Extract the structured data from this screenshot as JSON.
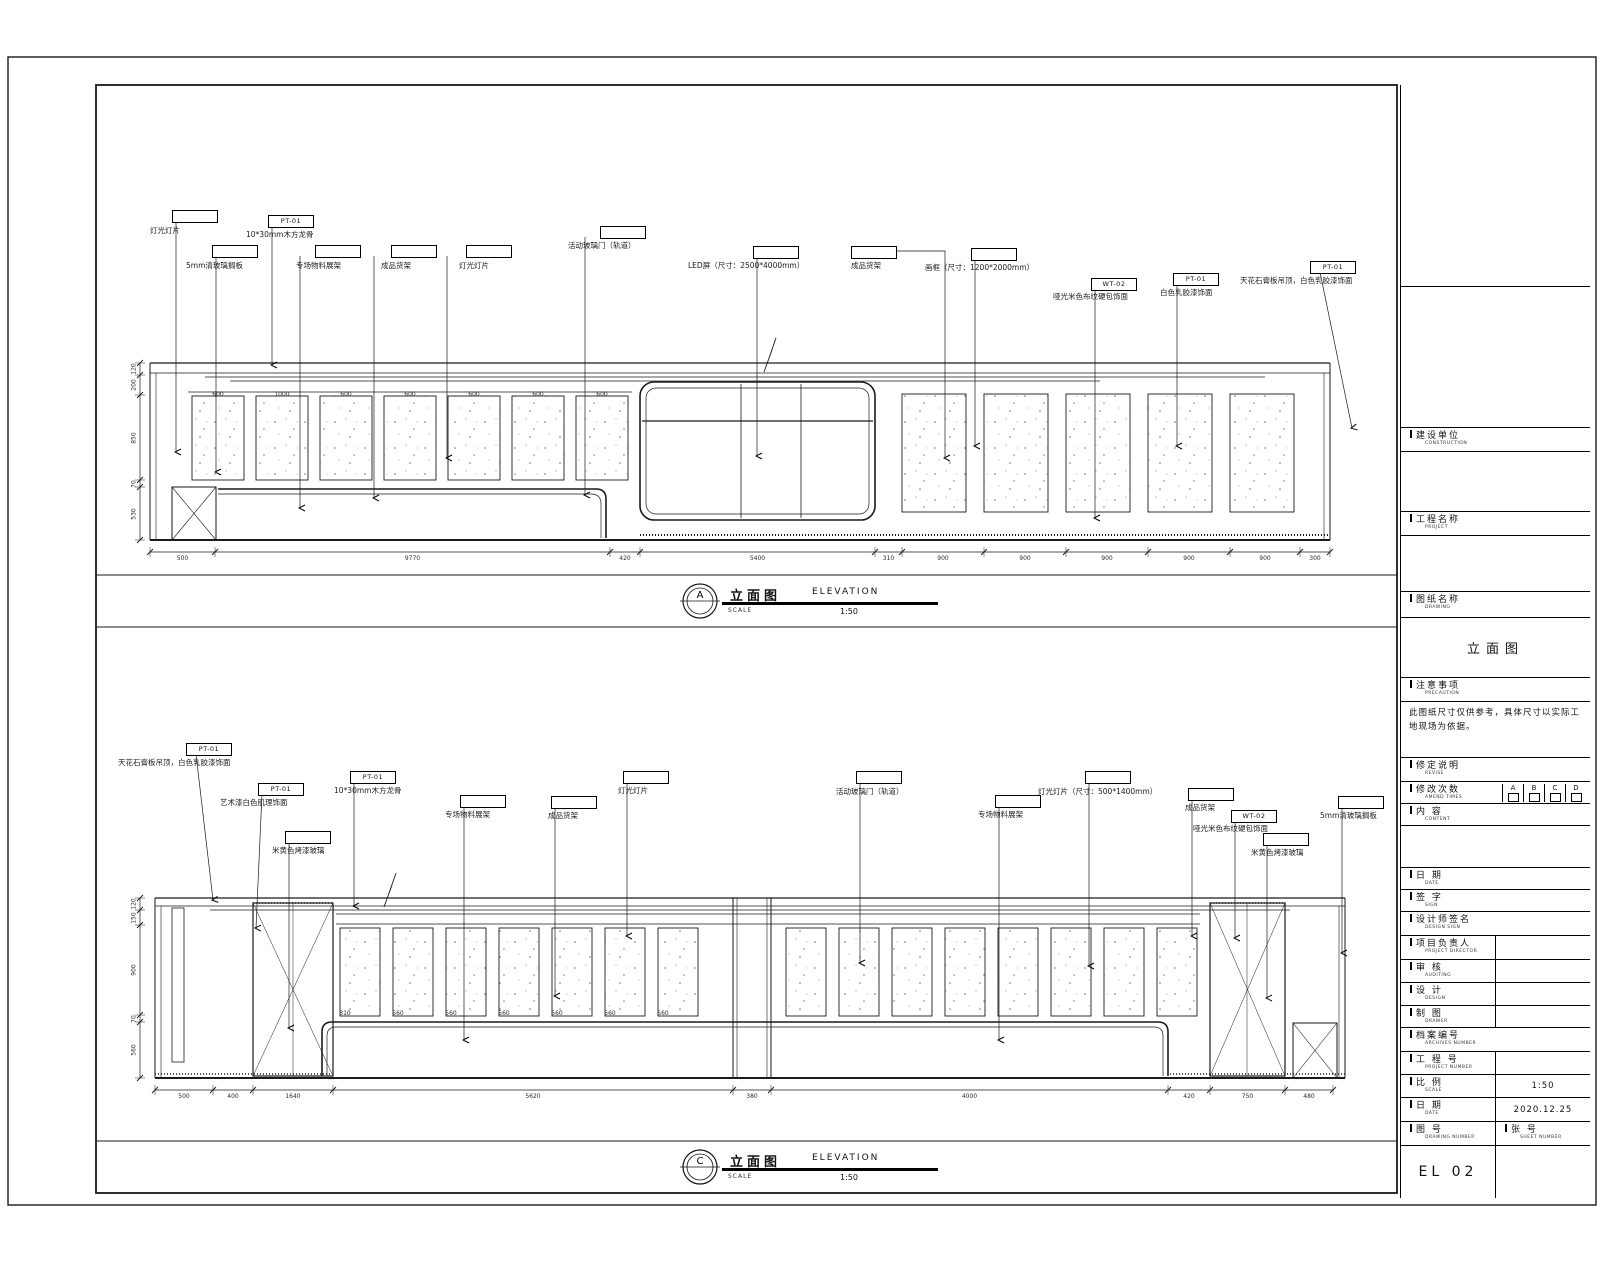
{
  "elevation_a": {
    "mark": "A",
    "title_zh": "立面图",
    "title_en": "ELEVATION",
    "scale_label": "SCALE",
    "scale": "1:50",
    "labels": [
      {
        "code": "",
        "text": "灯光灯片"
      },
      {
        "code": "PT-01",
        "text": "10*30mm木方龙骨"
      },
      {
        "code": "",
        "text": "5mm清玻璃搁板"
      },
      {
        "code": "",
        "text": "专场物料展架"
      },
      {
        "code": "",
        "text": "成品货架"
      },
      {
        "code": "",
        "text": "灯光灯片"
      },
      {
        "code": "",
        "text": "活动玻璃门（轨道）"
      },
      {
        "code": "",
        "text": "LED屏（尺寸：2500*4000mm）"
      },
      {
        "code": "",
        "text": "成品货架"
      },
      {
        "code": "",
        "text": "画框（尺寸：1200*2000mm）"
      },
      {
        "code": "WT-02",
        "text": "哑光米色布纹硬包饰面"
      },
      {
        "code": "PT-01",
        "text": "白色乳胶漆饰面"
      },
      {
        "code": "PT-01",
        "text": "天花石膏板吊顶，白色乳胶漆饰面"
      }
    ],
    "dims_bottom": [
      "500",
      "9770",
      "420",
      "5400",
      "310",
      "900",
      "900",
      "900",
      "900",
      "900",
      "300"
    ],
    "dims_left": [
      "120",
      "200",
      "850",
      "70",
      "530"
    ],
    "dims_panels": [
      "600",
      "1000",
      "600",
      "600",
      "600",
      "600",
      "600"
    ]
  },
  "elevation_c": {
    "mark": "C",
    "title_zh": "立面图",
    "title_en": "ELEVATION",
    "scale_label": "SCALE",
    "scale": "1:50",
    "labels": [
      {
        "code": "PT-01",
        "text": "天花石膏板吊顶，白色乳胶漆饰面"
      },
      {
        "code": "PT-01",
        "text": "艺术漆白色肌理饰面"
      },
      {
        "code": "PT-01",
        "text": "10*30mm木方龙骨"
      },
      {
        "code": "",
        "text": "米黄色烤漆玻璃"
      },
      {
        "code": "",
        "text": "专场物料展架"
      },
      {
        "code": "",
        "text": "成品货架"
      },
      {
        "code": "",
        "text": "灯光灯片"
      },
      {
        "code": "",
        "text": "活动玻璃门（轨道）"
      },
      {
        "code": "",
        "text": "专场物料展架"
      },
      {
        "code": "",
        "text": "灯光灯片（尺寸：500*1400mm）"
      },
      {
        "code": "",
        "text": "成品货架"
      },
      {
        "code": "WT-02",
        "text": "哑光米色布纹硬包饰面"
      },
      {
        "code": "",
        "text": "米黄色烤漆玻璃"
      },
      {
        "code": "",
        "text": "5mm清玻璃搁板"
      }
    ],
    "dims_bottom": [
      "500",
      "400",
      "1640",
      "5620",
      "380",
      "4000",
      "420",
      "750",
      "480"
    ],
    "dims_left": [
      "120",
      "150",
      "900",
      "70",
      "560"
    ],
    "dims_panels": [
      "310",
      "560",
      "560",
      "560",
      "560",
      "560",
      "560"
    ]
  },
  "titleblock": {
    "construction_zh": "建设单位",
    "construction_en": "CONSTRUCTION",
    "project_zh": "工程名称",
    "project_en": "PROJECT",
    "drawing_zh": "图纸名称",
    "drawing_en": "DRAWING",
    "drawing_name": "立面图",
    "precaution_zh": "注意事项",
    "precaution_en": "PRECAUTION",
    "precaution_text": "此图纸尺寸仅供参考，具体尺寸以实际工地现场为依据。",
    "revision_zh": "修定说明",
    "revision_en": "REVISE",
    "amend_zh": "修改次数",
    "amend_en": "AMEND TIMES",
    "amend_options": [
      "A",
      "B",
      "C",
      "D"
    ],
    "content_zh": "内  容",
    "content_en": "CONTENT",
    "date1_zh": "日  期",
    "date1_en": "DATE",
    "sign_zh": "签  字",
    "sign_en": "SIGN",
    "designsign_zh": "设计师签名",
    "designsign_en": "DESIGN SIGN",
    "director_zh": "项目负责人",
    "director_en": "PROJECT DIRECTOR",
    "audit_zh": "审  核",
    "audit_en": "AUDITING",
    "design_zh": "设  计",
    "design_en": "DESIGN",
    "drawer_zh": "制  图",
    "drawer_en": "DRAWER",
    "archive_zh": "档案编号",
    "archive_en": "ARCHIVES NUMBER",
    "projno_zh": "工 程 号",
    "projno_en": "PROJECT NUMBER",
    "scale_zh": "比  例",
    "scale_en": "SCALE",
    "scale_value": "1:50",
    "date2_zh": "日  期",
    "date2_en": "DATE",
    "date2_value": "2020.12.25",
    "drawno_zh": "图  号",
    "drawno_en": "DRAWING NUMBER",
    "drawno_value": "EL 02",
    "sheetno_zh": "张  号",
    "sheetno_en": "SHEET NUMBER",
    "sheetno_value": ""
  }
}
